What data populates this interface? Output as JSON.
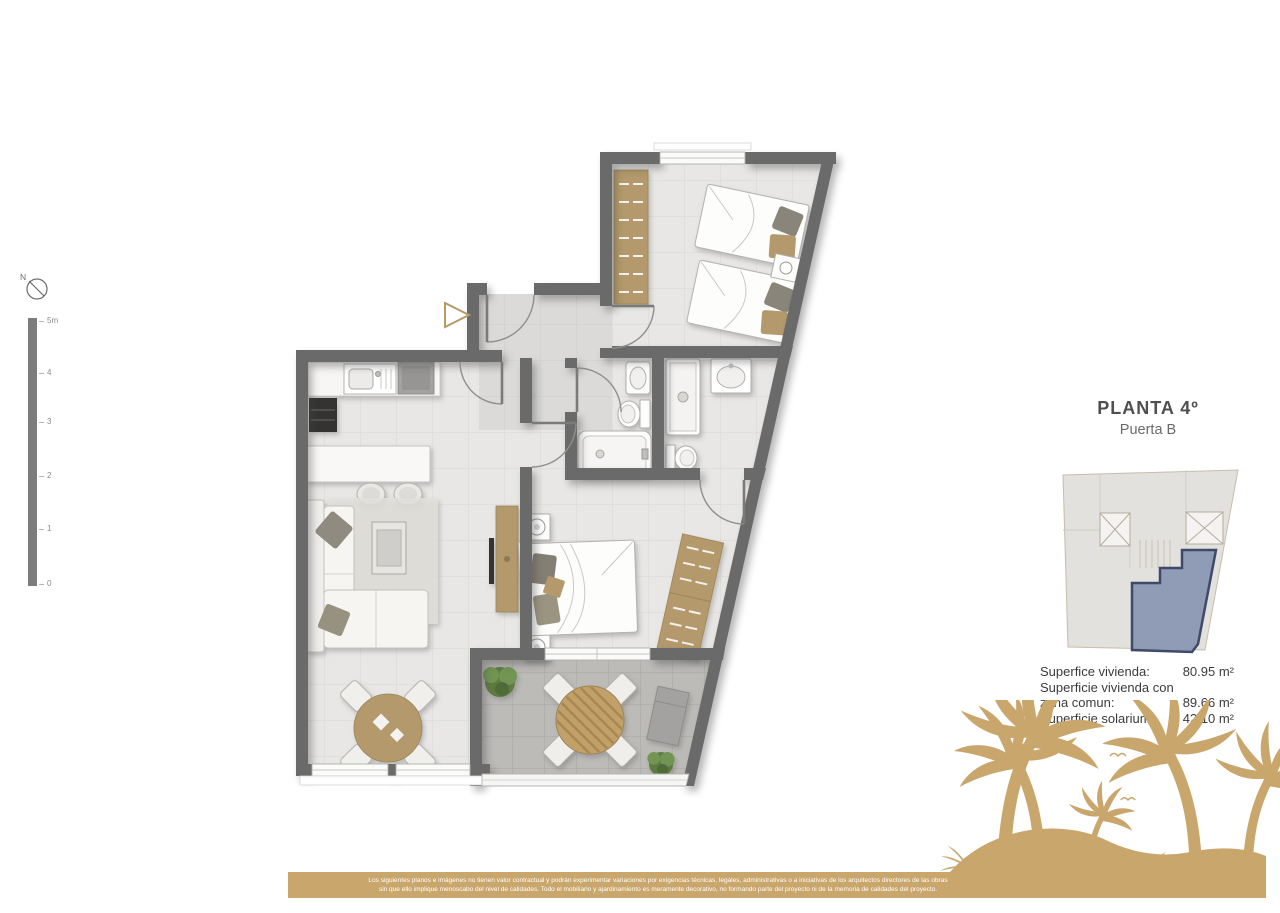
{
  "colors": {
    "wall": "#6a6a6a",
    "floor": "#e8e7e5",
    "floor_line": "#d8d7d4",
    "terrace": "#bcbbb8",
    "terrace_line": "#a7a6a3",
    "wood": "#b3996b",
    "sand": "#c9a66b",
    "highlight": "#8793b1",
    "highlight_outline": "#3e4a68",
    "keyplan_bg": "#e2e1de",
    "plant_green": "#5e7c42",
    "text_dark": "#4a4a4a"
  },
  "compass": {
    "north_label": "N"
  },
  "scale_bar": {
    "ticks": [
      "5m",
      "4",
      "3",
      "2",
      "1",
      "0"
    ]
  },
  "title_block": {
    "title": "PLANTA 4º",
    "subtitle": "Puerta B"
  },
  "areas": {
    "rows": [
      {
        "label": "Superfice vivienda:",
        "value": "80.95 m²"
      },
      {
        "label": "Superficie vivienda con zona comun:",
        "value": "89.66 m²"
      },
      {
        "label": "Superficie solarium:",
        "value": "42.10 m²"
      }
    ]
  },
  "footer": {
    "line1": "Los siguientes planos e imágenes no tienen valor contractual y podrán experimentar variaciones por exigencias técnicas, legales, administrativas o a iniciativas de los arquitectos directores de las obras",
    "line2": "sin que ello implique menoscabo del nivel de calidades. Todo el mobiliario y ajardinamiento es meramente decorativo, no formando parte del proyecto ni de la memoria de calidades del proyecto."
  }
}
